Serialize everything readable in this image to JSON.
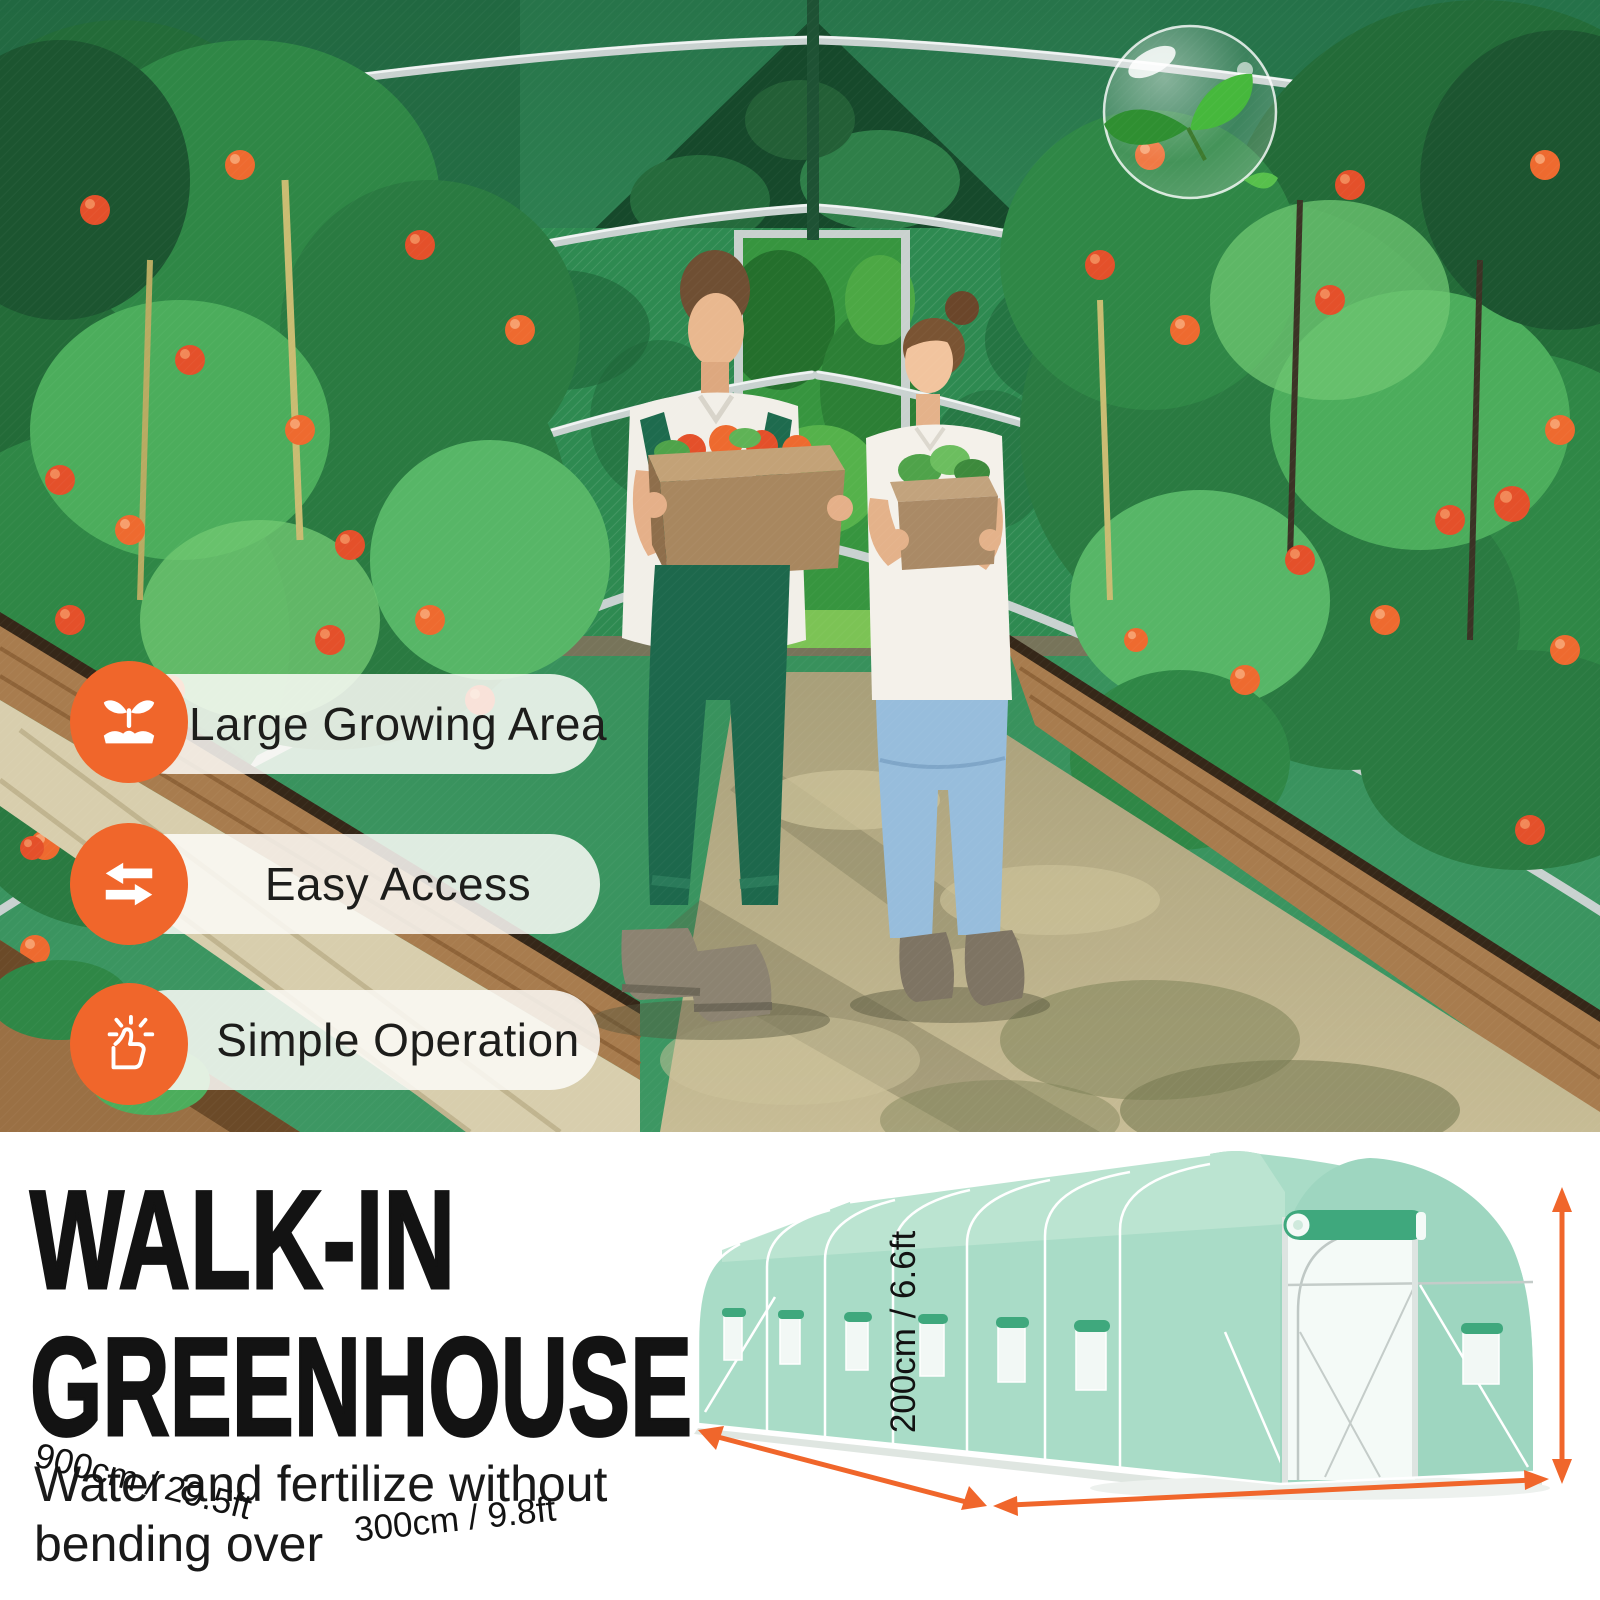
{
  "photo": {
    "features": [
      {
        "icon": "sprout-icon",
        "label": "Large Growing Area"
      },
      {
        "icon": "transfer-arrows-icon",
        "label": "Easy Access"
      },
      {
        "icon": "thumbs-up-icon",
        "label": "Simple Operation"
      }
    ],
    "scene": "two people carrying harvest boxes inside a green tunnel greenhouse with tomato beds"
  },
  "info": {
    "headline_line1": "WALK-IN",
    "headline_line2": "GREENHOUSE",
    "subtitle_line1": "Water and fertilize without",
    "subtitle_line2": "bending over"
  },
  "diagram": {
    "length_label": "900cm / 29.5ft",
    "width_label": "300cm / 9.8ft",
    "height_label": "200cm / 6.6ft"
  },
  "colors": {
    "accent_orange": "#F0662B",
    "pill_background": "rgba(253,252,248,0.85)",
    "greenhouse_seafoam": "#A9DCC7",
    "mesh_green": "#2E8A51",
    "headline_black": "#131313"
  }
}
